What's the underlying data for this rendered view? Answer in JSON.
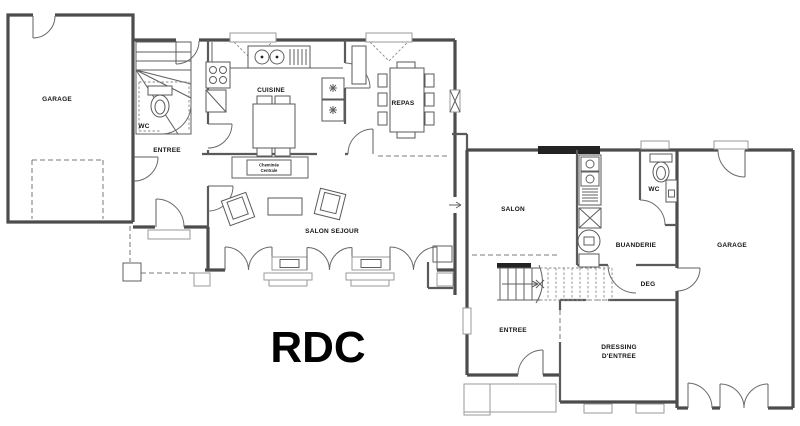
{
  "title": {
    "text": "RDC"
  },
  "colors": {
    "paper": "#ffffff",
    "wall_ink": "#4c4c4c",
    "label_ink": "#141414",
    "window_dark": "#232323"
  },
  "left_building": {
    "garage": "GARAGE",
    "wc": "WC",
    "entree": "ENTREE",
    "cuisine": "CUISINE",
    "repas": "REPAS",
    "salon_sejour": "SALON SEJOUR",
    "cheminee_line1": "Cheminée",
    "cheminee_line2": "Centrale"
  },
  "right_building": {
    "salon": "SALON",
    "buanderie": "BUANDERIE",
    "wc": "WC",
    "deg": "DEG",
    "entree": "ENTREE",
    "dressing_line1": "DRESSING",
    "dressing_line2": "D'ENTREE",
    "garage": "GARAGE"
  }
}
